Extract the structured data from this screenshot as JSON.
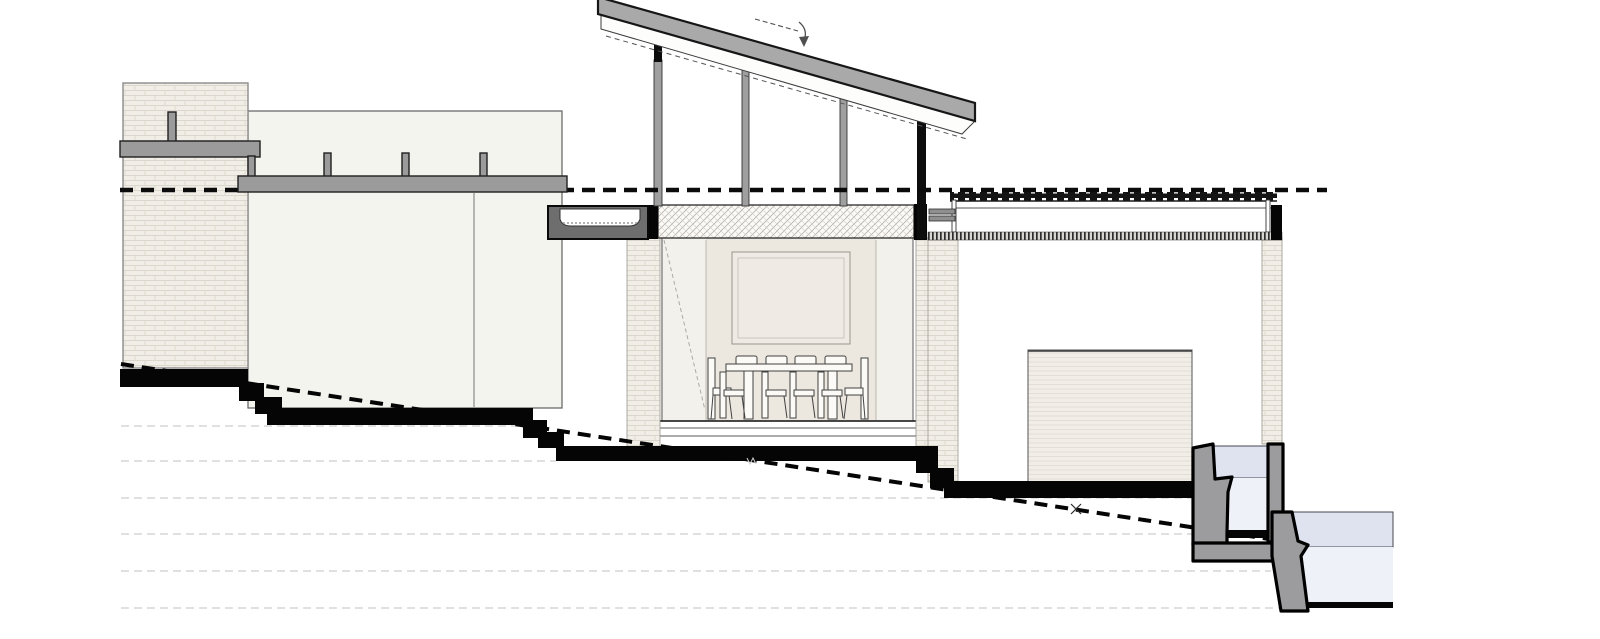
{
  "document": {
    "kind": "architectural-section-elevation",
    "visible_text": [],
    "notes_marks": [
      "grade-crossing-x-mark",
      "band-break-tick"
    ]
  },
  "colors": {
    "paper": "#ffffff",
    "ink": "#0b0b0b",
    "roof_gray": "#a9a9a9",
    "fascia_white": "#fdfdfc",
    "beam_gray": "#9b9b9b",
    "post_gray": "#9f9f9f",
    "gutter_gray": "#6e6e6e",
    "wall_light": "#f4f4ef",
    "brick_bg": "#f1eee7",
    "brick_line": "#dcd7cc",
    "interior_glass": "#f3f1eb",
    "interior_wall": "#ece7df",
    "picture_fill": "#efeae3",
    "slab_bg": "#fbfaf6",
    "slab_hatch": "#b7b3ab",
    "garage_bg": "#f1eee8",
    "garage_line": "#ddd9d0",
    "rib_dark": "#2d2d2d",
    "contour_gray": "#dcdcdc",
    "pool_gray": "#9c9c9e",
    "water_band": "#dfe3f0",
    "water_body": "#eef1f8",
    "chair_stroke": "#424242"
  },
  "components": [
    "upper-terrace-brick-wall",
    "left-house-block",
    "terrace-guardrail-upper",
    "terrace-guardrail-lower",
    "datum-dashed-line",
    "mono-pitch-clerestory-roof",
    "roof-fall-arrow",
    "roof-posts",
    "box-gutter",
    "dining-canopy-slab",
    "dining-room-glazing",
    "picture-frame",
    "dining-table",
    "dining-chairs",
    "flat-roof-right-wing",
    "right-wing-parapet",
    "garage-door",
    "brick-piers",
    "stepped-ground-cut",
    "grade-dashed-line",
    "contour-lines",
    "upper-water-basin",
    "lower-pool",
    "retaining-walls"
  ]
}
